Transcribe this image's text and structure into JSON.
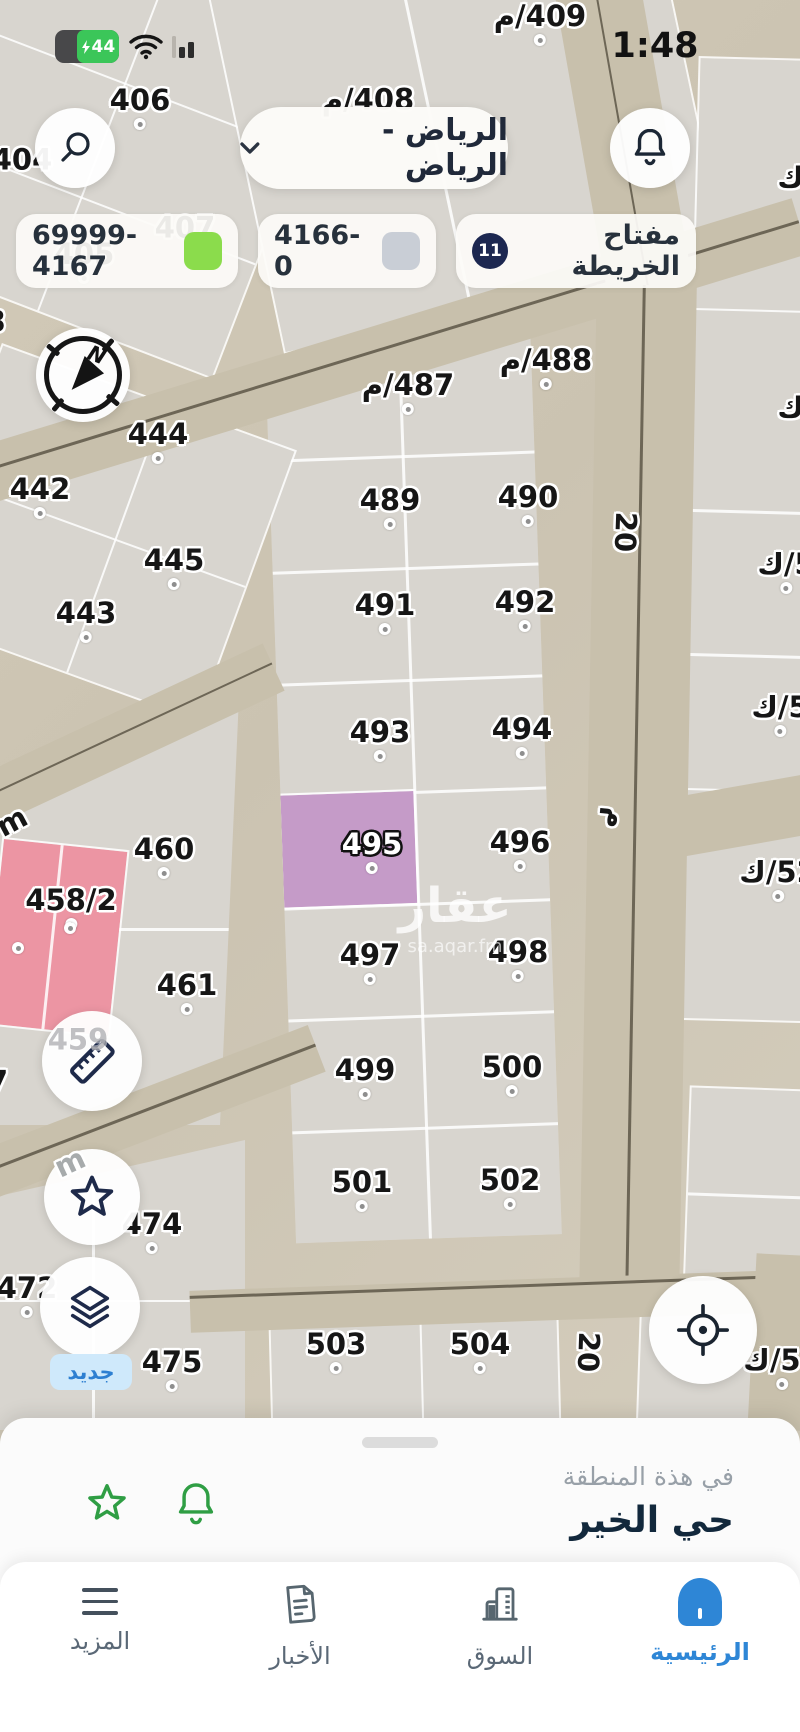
{
  "status_bar": {
    "battery": "44",
    "time": "1:48"
  },
  "header": {
    "region": "الرياض - الرياض"
  },
  "legend": {
    "item1": {
      "label": "69999- 4167",
      "color": "#8bdc4c"
    },
    "item2": {
      "label": "4166- 0",
      "color": "#c9ced6"
    },
    "item3": {
      "label": "مفتاح الخريطة",
      "badge": "11"
    }
  },
  "colors": {
    "legend_green": "#8bdc4c",
    "legend_gray": "#c9ced6",
    "badge_navy": "#1c2750",
    "highlight_plot": "#c59bc8",
    "pink_plot": "#ec95a3",
    "nav_active": "#2e86d6",
    "new_badge_bg": "#cfe9fb",
    "new_badge_text": "#2d7fd1",
    "battery_green": "#3bc659",
    "icon_green": "#2f9e44"
  },
  "map": {
    "watermark": {
      "line1": "عقار",
      "line2": "sa.aqar.fm"
    },
    "new_badge": "جديد",
    "plots": [
      {
        "t": "404",
        "x": 22,
        "y": 160,
        "dot": false
      },
      {
        "t": "406",
        "x": 140,
        "y": 108,
        "dot": true
      },
      {
        "t": "408/م",
        "x": 368,
        "y": 100,
        "dot": false
      },
      {
        "t": "409/م",
        "x": 540,
        "y": 24,
        "dot": true
      },
      {
        "t": "407",
        "x": 185,
        "y": 228,
        "dot": false
      },
      {
        "t": "405",
        "x": 84,
        "y": 262,
        "dot": true
      },
      {
        "t": "3",
        "x": -4,
        "y": 322,
        "dot": false
      },
      {
        "t": "444",
        "x": 158,
        "y": 442,
        "dot": true
      },
      {
        "t": "442",
        "x": 40,
        "y": 497,
        "dot": true
      },
      {
        "t": "445",
        "x": 174,
        "y": 568,
        "dot": true
      },
      {
        "t": "443",
        "x": 86,
        "y": 621,
        "dot": true
      },
      {
        "t": "487/م",
        "x": 408,
        "y": 393,
        "dot": true
      },
      {
        "t": "488/م",
        "x": 546,
        "y": 368,
        "dot": true
      },
      {
        "t": "489",
        "x": 390,
        "y": 508,
        "dot": true
      },
      {
        "t": "490",
        "x": 528,
        "y": 505,
        "dot": true
      },
      {
        "t": "491",
        "x": 385,
        "y": 613,
        "dot": true
      },
      {
        "t": "492",
        "x": 525,
        "y": 610,
        "dot": true
      },
      {
        "t": "493",
        "x": 380,
        "y": 740,
        "dot": true
      },
      {
        "t": "494",
        "x": 522,
        "y": 737,
        "dot": true
      },
      {
        "t": "495",
        "x": 372,
        "y": 852,
        "dot": true,
        "variant": "light"
      },
      {
        "t": "496",
        "x": 520,
        "y": 850,
        "dot": true
      },
      {
        "t": "497",
        "x": 370,
        "y": 963,
        "dot": true
      },
      {
        "t": "498",
        "x": 518,
        "y": 960,
        "dot": true
      },
      {
        "t": "499",
        "x": 365,
        "y": 1078,
        "dot": true
      },
      {
        "t": "500",
        "x": 512,
        "y": 1075,
        "dot": true
      },
      {
        "t": "501",
        "x": 362,
        "y": 1190,
        "dot": true
      },
      {
        "t": "502",
        "x": 510,
        "y": 1188,
        "dot": true
      },
      {
        "t": "503",
        "x": 336,
        "y": 1352,
        "dot": true
      },
      {
        "t": "504",
        "x": 480,
        "y": 1352,
        "dot": true
      },
      {
        "t": "460",
        "x": 164,
        "y": 857,
        "dot": true
      },
      {
        "t": "458/2",
        "x": 71,
        "y": 908,
        "dot": true
      },
      {
        "t": "461",
        "x": 187,
        "y": 993,
        "dot": true
      },
      {
        "t": "459",
        "x": 78,
        "y": 1040,
        "dot": false,
        "variant": "faint"
      },
      {
        "t": "7",
        "x": -2,
        "y": 1082,
        "dot": false
      },
      {
        "t": "474",
        "x": 152,
        "y": 1232,
        "dot": true
      },
      {
        "t": "472",
        "x": 27,
        "y": 1296,
        "dot": true
      },
      {
        "t": "475",
        "x": 172,
        "y": 1370,
        "dot": true
      },
      {
        "t": "5/ك",
        "x": 806,
        "y": 178,
        "dot": false
      },
      {
        "t": "5/ك",
        "x": 806,
        "y": 408,
        "dot": false
      },
      {
        "t": "5/ك",
        "x": 786,
        "y": 572,
        "dot": true
      },
      {
        "t": "5/ك",
        "x": 780,
        "y": 715,
        "dot": true
      },
      {
        "t": "52/ك",
        "x": 778,
        "y": 880,
        "dot": true
      },
      {
        "t": "52/ك",
        "x": 782,
        "y": 1368,
        "dot": true
      }
    ],
    "street_labels": [
      {
        "t": "20",
        "x": 625,
        "y": 532,
        "rot": 92
      },
      {
        "t": "م",
        "x": 616,
        "y": 818,
        "rot": 95
      },
      {
        "t": "20",
        "x": 588,
        "y": 1352,
        "rot": 92
      },
      {
        "t": "m",
        "x": 12,
        "y": 822,
        "rot": -28
      },
      {
        "t": "m",
        "x": 70,
        "y": 1163,
        "rot": -25,
        "variant": "over"
      }
    ],
    "dots": [
      {
        "x": 18,
        "y": 948
      },
      {
        "x": 70,
        "y": 928
      }
    ]
  },
  "bottom_sheet": {
    "subtitle": "في هذة المنطقة",
    "title": "حي الخير"
  },
  "nav": {
    "items": [
      {
        "label": "المزيد"
      },
      {
        "label": "الأخبار"
      },
      {
        "label": "السوق"
      },
      {
        "label": "الرئيسية"
      }
    ]
  }
}
